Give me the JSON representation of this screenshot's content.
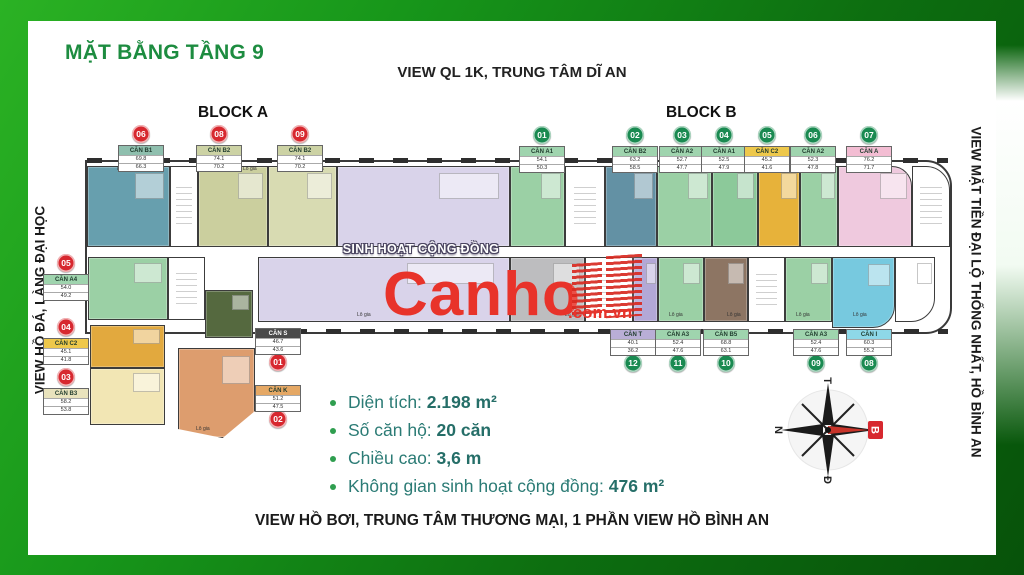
{
  "header": {
    "title": "MẶT BẰNG TẦNG 9"
  },
  "views": {
    "top": "VIEW QL 1K, TRUNG TÂM DĨ AN",
    "left": "VIEW HỒ ĐÁ, LÀNG ĐẠI HỌC",
    "right": "VIEW MẶT TIỀN ĐẠI LỘ THỐNG NHẤT, HỒ BÌNH AN",
    "bottom": "VIEW HỒ BƠI, TRUNG TÂM THƯƠNG MẠI, 1 PHẦN VIEW HỒ BÌNH AN"
  },
  "blocks": {
    "a": "BLOCK A",
    "b": "BLOCK B"
  },
  "community_label": "SINH HOẠT CỘNG ĐỒNG",
  "loggia_label": "Lô gia",
  "watermark": {
    "brand": "Canho",
    "suffix": ".com.vn",
    "color": "#e8332a"
  },
  "stats": [
    {
      "label": "Diện tích: ",
      "value": "2.198 m²"
    },
    {
      "label": "Số căn hộ: ",
      "value": "20 căn"
    },
    {
      "label": "Chiều cao: ",
      "value": "3,6 m"
    },
    {
      "label": "Không gian sinh hoạt cộng đồng: ",
      "value": "476 m²"
    }
  ],
  "compass": {
    "north": "B",
    "east": "Đ",
    "south": "N",
    "west": "T",
    "north_color": "#d7282f"
  },
  "colors": {
    "frame_green": "#18a018",
    "title_green": "#1d8c40",
    "stats_teal": "#2b7b75",
    "badge_red": "#d7282f",
    "badge_green": "#1a8a51",
    "wall": "#3a3a3a"
  },
  "palette": {
    "teal": "#679fae",
    "khaki": "#cbcf9e",
    "khaki2": "#d8dbb2",
    "lavender": "#d9d3ea",
    "green": "#9bd0a5",
    "green2": "#8cc99a",
    "steel": "#6391a4",
    "gold": "#e7b23a",
    "pink": "#efc9de",
    "gray": "#bdbdbf",
    "purple": "#b3a8d6",
    "brown": "#8d7563",
    "cyan": "#77c9df",
    "darkgreen": "#55693f",
    "gold2": "#e2a93e",
    "pale": "#f2e6b4",
    "salmon": "#dd9d6e",
    "white": "#ffffff"
  },
  "units": [
    {
      "id": "a06",
      "badge": "06",
      "name": "CĂN B1",
      "rows": [
        "69.8",
        "66.3"
      ],
      "badge_color": "#d7282f",
      "head": "#8fbfae"
    },
    {
      "id": "a08",
      "badge": "08",
      "name": "CĂN B2",
      "rows": [
        "74.1",
        "70.2"
      ],
      "badge_color": "#d7282f",
      "head": "#ccd2a4"
    },
    {
      "id": "a09",
      "badge": "09",
      "name": "CĂN B2",
      "rows": [
        "74.1",
        "70.2"
      ],
      "badge_color": "#d7282f",
      "head": "#ccd2a4"
    },
    {
      "id": "b01",
      "badge": "01",
      "name": "CĂN A1",
      "rows": [
        "54.1",
        "50.3"
      ],
      "badge_color": "#1a8a51",
      "head": "#9fd4ae"
    },
    {
      "id": "b02",
      "badge": "02",
      "name": "CĂN B2",
      "rows": [
        "63.2",
        "58.5"
      ],
      "badge_color": "#1a8a51",
      "head": "#9fd4ae"
    },
    {
      "id": "b03",
      "badge": "03",
      "name": "CĂN A2",
      "rows": [
        "52.7",
        "47.7"
      ],
      "badge_color": "#1a8a51",
      "head": "#9fd4ae"
    },
    {
      "id": "b04",
      "badge": "04",
      "name": "CĂN A1",
      "rows": [
        "52.5",
        "47.9"
      ],
      "badge_color": "#1a8a51",
      "head": "#9fd4ae"
    },
    {
      "id": "b05",
      "badge": "05",
      "name": "CĂN C2",
      "rows": [
        "45.2",
        "41.6"
      ],
      "badge_color": "#1a8a51",
      "head": "#eec84b"
    },
    {
      "id": "b06",
      "badge": "06",
      "name": "CĂN A2",
      "rows": [
        "52.3",
        "47.8"
      ],
      "badge_color": "#1a8a51",
      "head": "#9fd4ae"
    },
    {
      "id": "b07",
      "badge": "07",
      "name": "CĂN A",
      "rows": [
        "76.2",
        "71.7"
      ],
      "badge_color": "#1a8a51",
      "head": "#f3bdd3"
    },
    {
      "id": "l05",
      "badge": "05",
      "name": "CĂN A4",
      "rows": [
        "54.0",
        "49.2"
      ],
      "badge_color": "#d7282f",
      "head": "#9fd4ae"
    },
    {
      "id": "l04",
      "badge": "04",
      "name": "CĂN C2",
      "rows": [
        "45.1",
        "41.8"
      ],
      "badge_color": "#d7282f",
      "head": "#eec84b"
    },
    {
      "id": "l03",
      "badge": "03",
      "name": "CĂN B3",
      "rows": [
        "58.2",
        "53.8"
      ],
      "badge_color": "#d7282f",
      "head": "#e9e3bd"
    },
    {
      "id": "wl01",
      "badge": "01",
      "name": "CĂN S",
      "rows": [
        "46.7",
        "43.6"
      ],
      "badge_color": "#d7282f",
      "head": "#4a4a4a",
      "dark": true
    },
    {
      "id": "wl02",
      "badge": "02",
      "name": "CĂN K",
      "rows": [
        "51.2",
        "47.5"
      ],
      "badge_color": "#d7282f",
      "head": "#e5a865"
    },
    {
      "id": "bb12",
      "badge": "12",
      "name": "CĂN T",
      "rows": [
        "40.1",
        "36.2"
      ],
      "badge_color": "#1a8a51",
      "head": "#b9aed6"
    },
    {
      "id": "bb11",
      "badge": "11",
      "name": "CĂN A3",
      "rows": [
        "52.4",
        "47.6"
      ],
      "badge_color": "#1a8a51",
      "head": "#9fd4ae"
    },
    {
      "id": "bb10",
      "badge": "10",
      "name": "CĂN B5",
      "rows": [
        "68.8",
        "63.1"
      ],
      "badge_color": "#1a8a51",
      "head": "#9fd4ae"
    },
    {
      "id": "bb09",
      "badge": "09",
      "name": "CĂN A3",
      "rows": [
        "52.4",
        "47.6"
      ],
      "badge_color": "#1a8a51",
      "head": "#9fd4ae"
    },
    {
      "id": "bb08",
      "badge": "08",
      "name": "CĂN I",
      "rows": [
        "60.3",
        "55.2"
      ],
      "badge_color": "#1a8a51",
      "head": "#8ed8e8"
    }
  ]
}
